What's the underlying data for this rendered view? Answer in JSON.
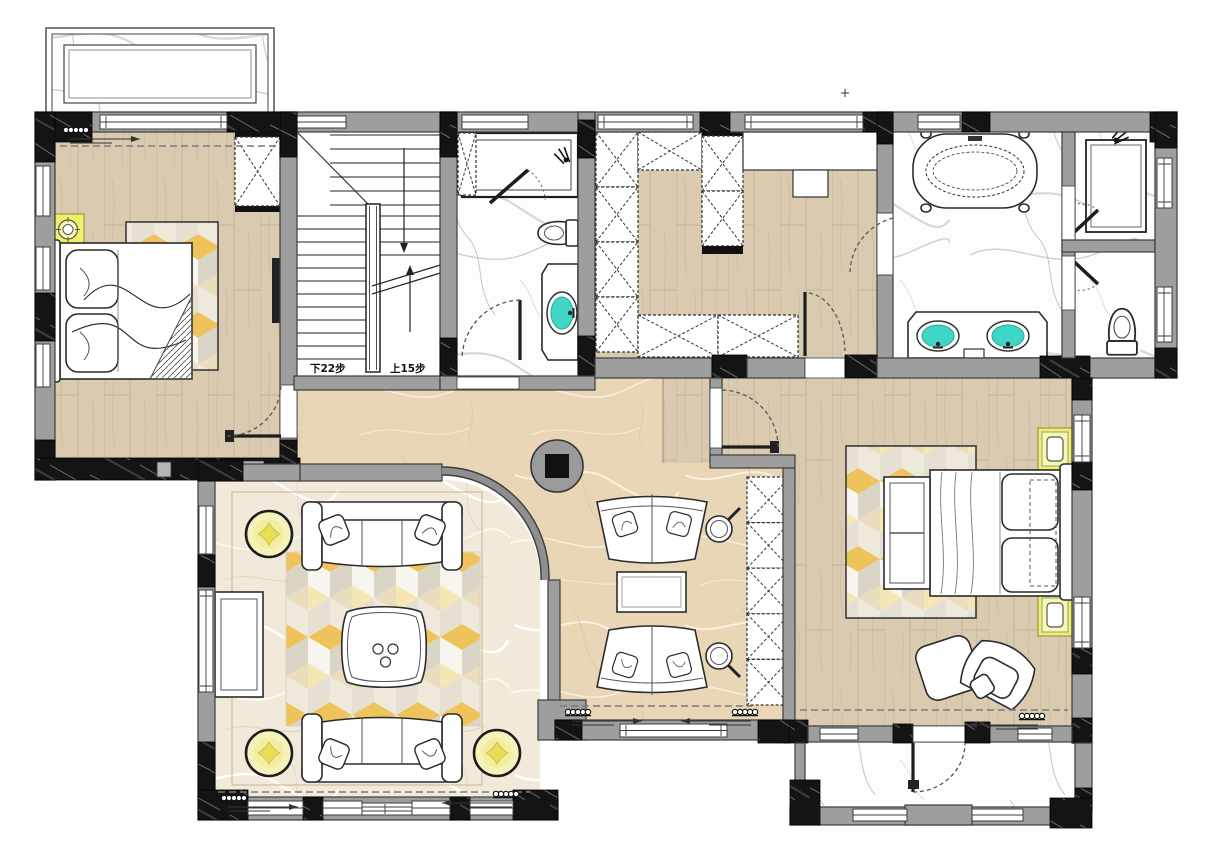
{
  "stairs": {
    "down_label": "下22步",
    "up_label": "上15步"
  },
  "colors": {
    "wall_gray": "#9e9e9e",
    "structure_black": "#121212",
    "wood_floor": "#d9cab0",
    "hall_marble": "#e9d8ba",
    "bath_marble": "#fdfdfd",
    "sitting_floor": "#f2ebdd",
    "nightstand_yellow": "#eef06a",
    "pouf_yellow": "#f3eda0",
    "sink_teal": "#3fd6c6",
    "rug_yellow": "#eec35b"
  }
}
